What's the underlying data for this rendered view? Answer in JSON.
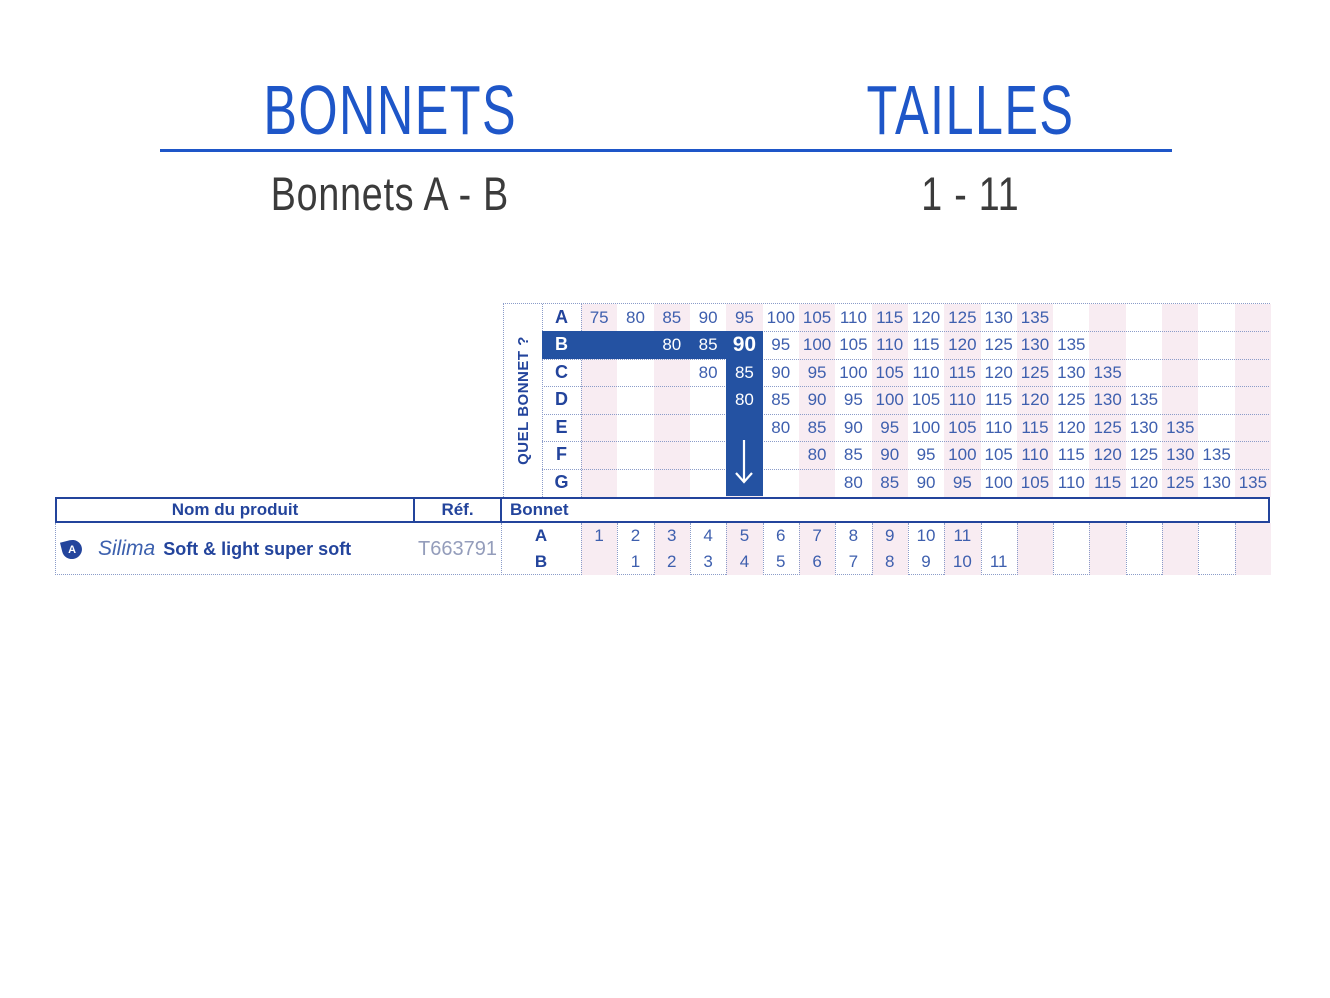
{
  "header": {
    "left_title": "BONNETS",
    "right_title": "TAILLES",
    "left_subtitle": "Bonnets A - B",
    "right_subtitle": "1 - 11"
  },
  "size_chart": {
    "side_label": "QUEL BONNET ?",
    "columns": 19,
    "selection": {
      "cup": "B",
      "value": "90",
      "column": 5,
      "arrow": "down-arrow"
    },
    "rows": [
      {
        "cup": "A",
        "start_col": 1,
        "values": [
          "75",
          "80",
          "85",
          "90",
          "95",
          "100",
          "105",
          "110",
          "115",
          "120",
          "125",
          "130",
          "135"
        ]
      },
      {
        "cup": "B",
        "start_col": 3,
        "highlighted_row": true,
        "values": [
          "80",
          "85",
          "90",
          "95",
          "100",
          "105",
          "110",
          "115",
          "120",
          "125",
          "130",
          "135"
        ]
      },
      {
        "cup": "C",
        "start_col": 4,
        "values": [
          "80",
          "85",
          "90",
          "95",
          "100",
          "105",
          "110",
          "115",
          "120",
          "125",
          "130",
          "135"
        ]
      },
      {
        "cup": "D",
        "start_col": 5,
        "values": [
          "80",
          "85",
          "90",
          "95",
          "100",
          "105",
          "110",
          "115",
          "120",
          "125",
          "130",
          "135"
        ]
      },
      {
        "cup": "E",
        "start_col": 6,
        "values": [
          "80",
          "85",
          "90",
          "95",
          "100",
          "105",
          "110",
          "115",
          "120",
          "125",
          "130",
          "135"
        ]
      },
      {
        "cup": "F",
        "start_col": 7,
        "values": [
          "80",
          "85",
          "90",
          "95",
          "100",
          "105",
          "110",
          "115",
          "120",
          "125",
          "130",
          "135"
        ]
      },
      {
        "cup": "G",
        "start_col": 8,
        "values": [
          "80",
          "85",
          "90",
          "95",
          "100",
          "105",
          "110",
          "115",
          "120",
          "125",
          "130",
          "135"
        ]
      }
    ]
  },
  "product_table": {
    "columns": [
      {
        "label": "Nom du produit"
      },
      {
        "label": "Réf."
      },
      {
        "label": "Bonnet"
      }
    ],
    "product": {
      "badge": "A",
      "brand": "Silima",
      "name": "Soft & light super soft",
      "reference": "T663791",
      "sizes": [
        {
          "cup": "A",
          "start_col": 1,
          "values": [
            "1",
            "2",
            "3",
            "4",
            "5",
            "6",
            "7",
            "8",
            "9",
            "10",
            "11"
          ]
        },
        {
          "cup": "B",
          "start_col": 2,
          "values": [
            "1",
            "2",
            "3",
            "4",
            "5",
            "6",
            "7",
            "8",
            "9",
            "10",
            "11"
          ]
        }
      ]
    }
  },
  "colors": {
    "title_blue": "#1e56c8",
    "navy": "#23449c",
    "bar_blue": "#2452a2",
    "value_blue": "#3e5fae",
    "stripe_pink": "#f8ecf2",
    "dotted_line": "#8b9cc9",
    "ref_grey": "#949dbb",
    "subtitle_dark": "#3b3b3b"
  }
}
